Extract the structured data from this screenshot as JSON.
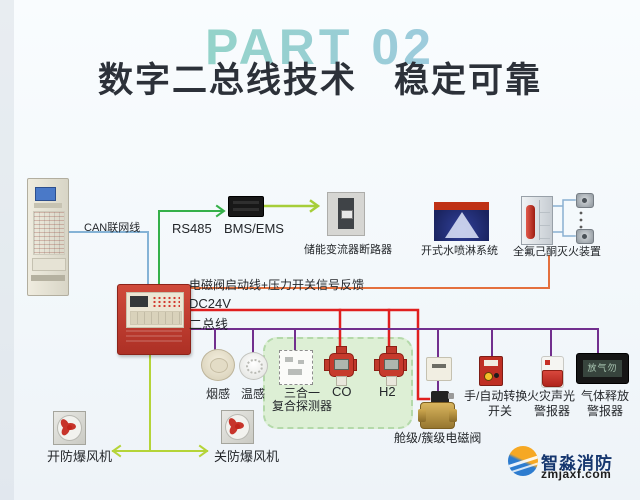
{
  "header": {
    "part_label": "PART 02",
    "title": "数字二总线技术　稳定可靠"
  },
  "colors": {
    "can_line": "#85b3d6",
    "rs485_line": "#35b04a",
    "link_arrow": "#a6ce39",
    "solenoid_line": "#e4703d",
    "dc24v_line": "#e01f1f",
    "bus_line": "#722f8e",
    "fan_line": "#b5d438",
    "bracket_line": "#8ab0d2",
    "panel_red": "#c13a30",
    "zone_green": "#ddefd5"
  },
  "lines": {
    "can_label": "CAN联网线",
    "rs485_label": "RS485",
    "solenoid_feedback_label": "电磁阀启动线+压力开关信号反馈",
    "dc24v_label": "DC24V",
    "bus_label": "二总线"
  },
  "devices": {
    "bms": {
      "label": "BMS/EMS"
    },
    "breaker": {
      "label": "储能变流器断路器"
    },
    "sprinkler": {
      "label": "开式水喷淋系统"
    },
    "suppression": {
      "label": "全氟己酮灭火装置"
    },
    "smoke": {
      "label": "烟感"
    },
    "heat": {
      "label": "温感"
    },
    "combo": {
      "label_line1": "三合一",
      "label_line2": "复合探测器"
    },
    "co": {
      "label": "CO"
    },
    "h2": {
      "label": "H2"
    },
    "valve": {
      "label": "舱级/簇级电磁阀"
    },
    "manual_switch": {
      "label_line1": "手/自动转换",
      "label_line2": "开关"
    },
    "strobe": {
      "label_line1": "火灾声光",
      "label_line2": "警报器"
    },
    "gas_sign": {
      "label_line1": "气体释放",
      "label_line2": "警报器",
      "screen_text": "放气勿入"
    },
    "fan_open": {
      "label": "开防爆风机"
    },
    "fan_close": {
      "label": "关防爆风机"
    }
  },
  "footer": {
    "brand": "智淼消防",
    "site": "zmjaxf.com"
  }
}
